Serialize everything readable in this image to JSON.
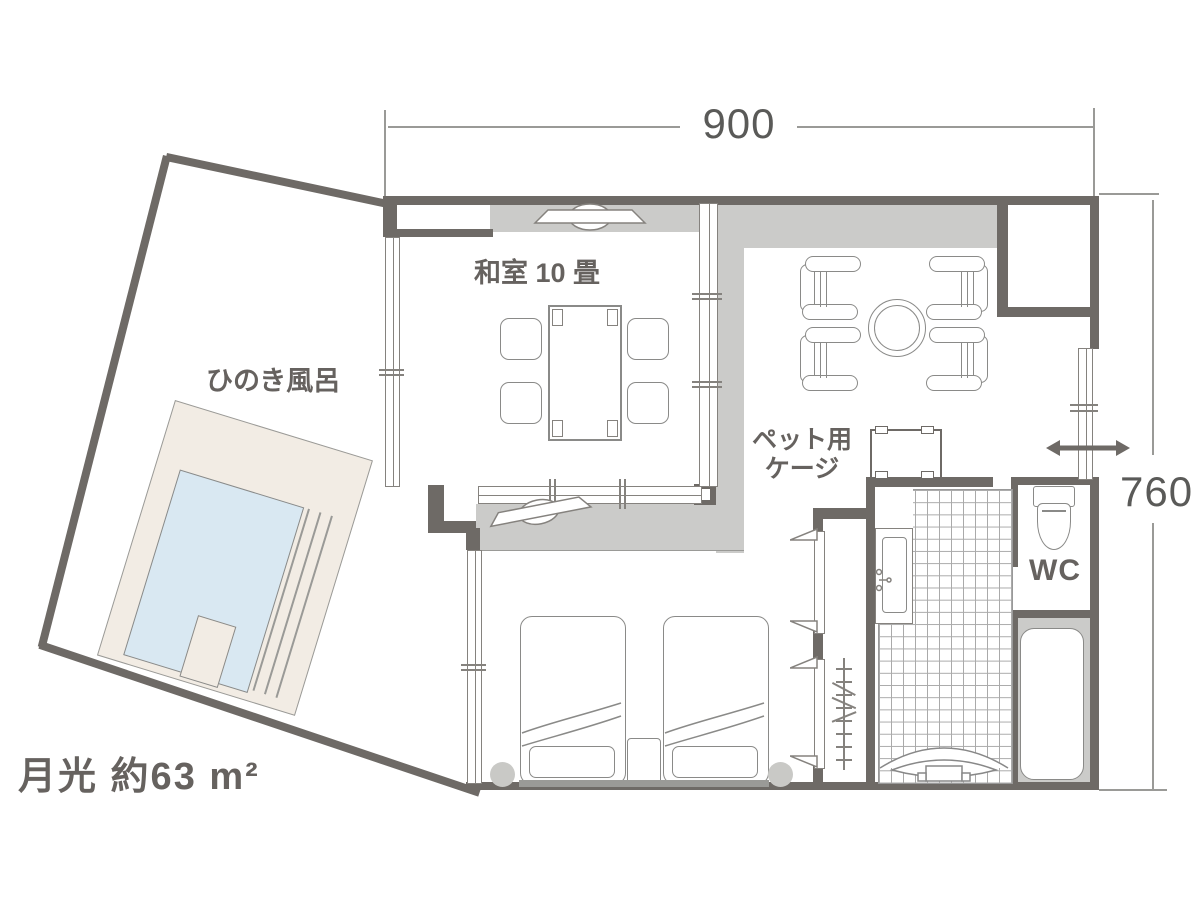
{
  "plan": {
    "room_title": "月光 約63 m²",
    "dimensions": {
      "width_label": "900",
      "height_label": "760"
    },
    "labels": {
      "washitsu": "和室 10 畳",
      "hinoki_bath": "ひのき風呂",
      "pet_cage_line1": "ペット用",
      "pet_cage_line2": "ケージ",
      "wc": "WC"
    },
    "legend": {
      "washitsu_desc": "Japanese-style room 10 tatami with low table, 4 cushions, TV alcove",
      "features": "twin beds, armchair lounge, pet cage, hinoki outdoor bath, WC, unit bath, tiled entrance"
    },
    "colors": {
      "wall": "#6e6a66",
      "floor_gray": "#cbcbc9",
      "deck_beige": "#f2ece4",
      "water_blue": "#d9e8f2",
      "furniture_outline": "#8a8a88"
    }
  }
}
